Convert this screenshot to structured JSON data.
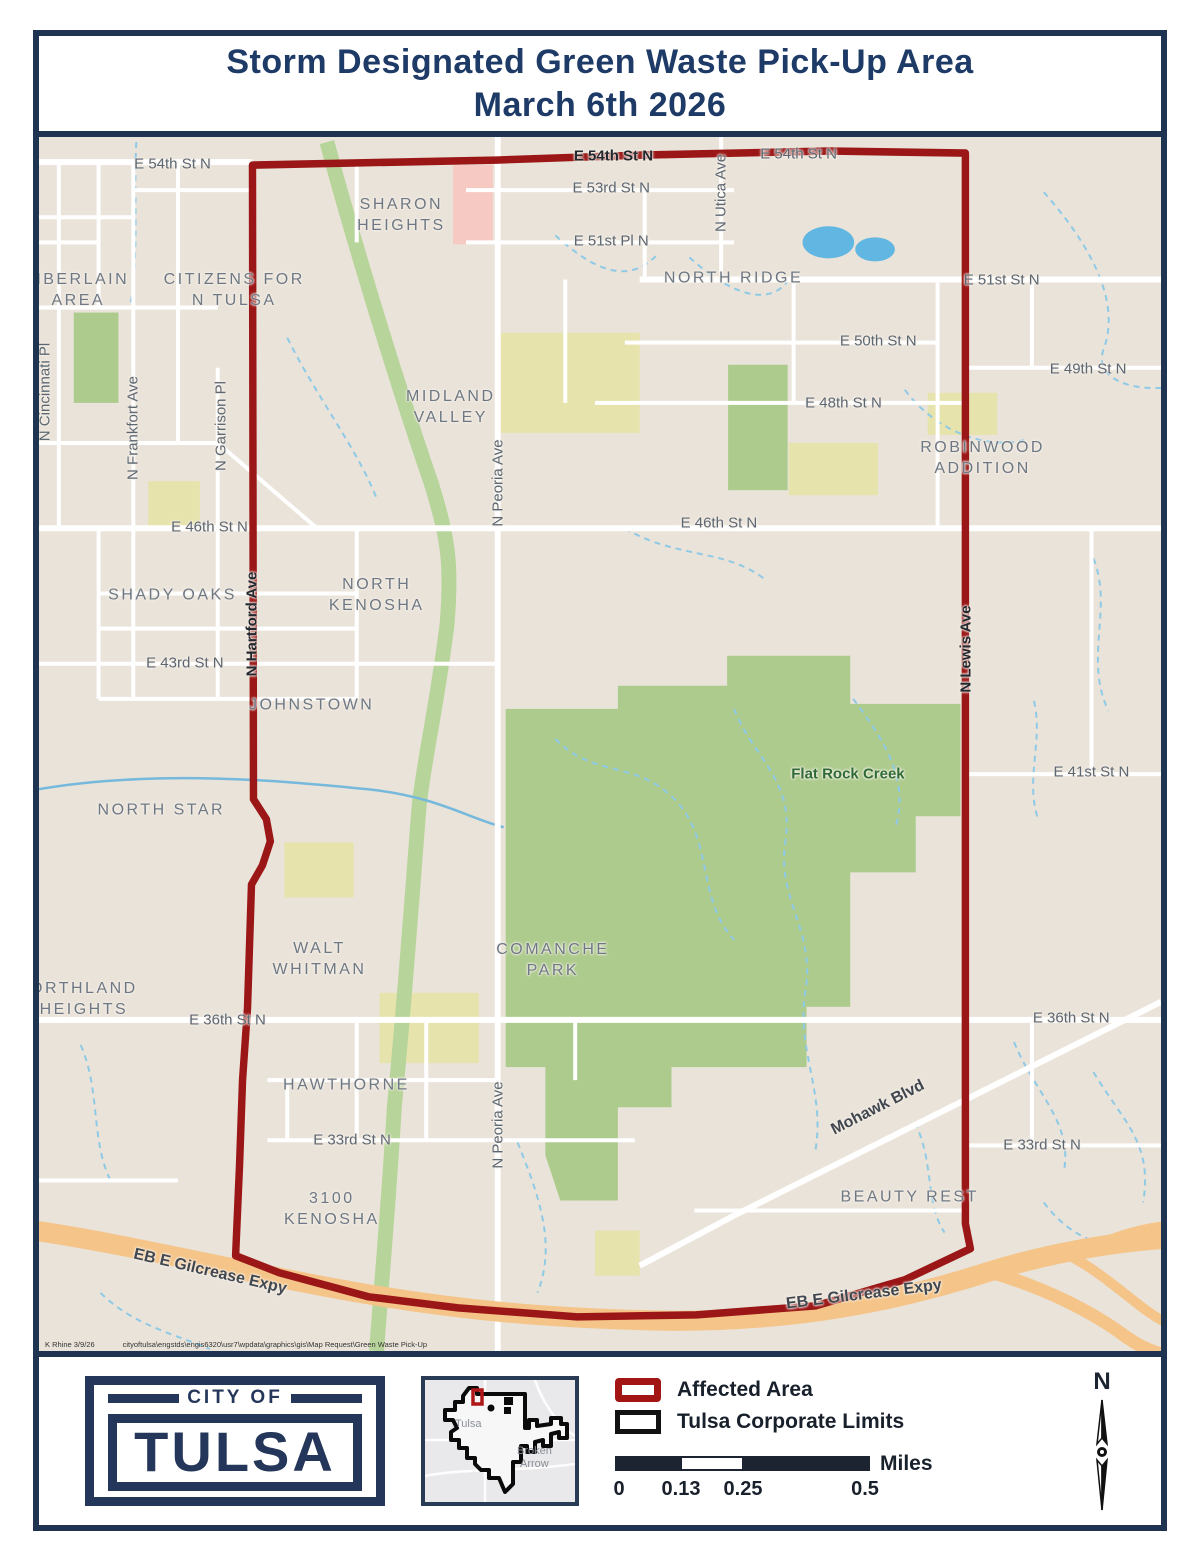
{
  "title": {
    "line1": "Storm Designated Green Waste Pick-Up Area",
    "line2": "March 6th 2026"
  },
  "colors": {
    "navy": "#1f3450",
    "boundary_red": "#9b1717",
    "legend_red": "#a31515",
    "map_bg": "#eae3d9",
    "park_green": "#aecb8e",
    "expressway_orange": "#f5c488",
    "water_blue": "#62b6e2"
  },
  "map": {
    "credit_author": "K Rhine 3/9/26",
    "credit_path": "cityoftulsa\\engstds\\engis6320\\usr7\\wpdata\\graphics\\gis\\Map Request\\Green Waste Pick-Up",
    "labels": [
      {
        "text": "E 54th St N",
        "x": 11.9,
        "y": 2.2,
        "cls": "st"
      },
      {
        "text": "E 54th St N",
        "x": 51.2,
        "y": 1.6,
        "cls": "std"
      },
      {
        "text": "E 54th St N",
        "x": 67.7,
        "y": 1.4,
        "cls": "st"
      },
      {
        "text": "E 53rd St N",
        "x": 51.0,
        "y": 4.2,
        "cls": "st"
      },
      {
        "text": "E 51st Pl N",
        "x": 51.0,
        "y": 8.6,
        "cls": "st"
      },
      {
        "text": "E 51st St N",
        "x": 85.8,
        "y": 11.8,
        "cls": "st"
      },
      {
        "text": "E 50th St N",
        "x": 74.8,
        "y": 16.8,
        "cls": "st"
      },
      {
        "text": "E 49th St N",
        "x": 93.5,
        "y": 19.1,
        "cls": "st"
      },
      {
        "text": "E 48th St N",
        "x": 71.7,
        "y": 21.9,
        "cls": "st"
      },
      {
        "text": "E 46th St N",
        "x": 15.2,
        "y": 32.1,
        "cls": "st"
      },
      {
        "text": "E 46th St N",
        "x": 60.6,
        "y": 31.8,
        "cls": "st"
      },
      {
        "text": "E 43rd St N",
        "x": 13.0,
        "y": 43.3,
        "cls": "st"
      },
      {
        "text": "E 41st St N",
        "x": 93.8,
        "y": 52.3,
        "cls": "st"
      },
      {
        "text": "E 36th St N",
        "x": 16.8,
        "y": 72.7,
        "cls": "st"
      },
      {
        "text": "E 36th St N",
        "x": 92.0,
        "y": 72.6,
        "cls": "st"
      },
      {
        "text": "E 33rd St N",
        "x": 27.9,
        "y": 82.6,
        "cls": "st"
      },
      {
        "text": "E 33rd St N",
        "x": 89.4,
        "y": 83.0,
        "cls": "st"
      },
      {
        "text": "Mohawk Blvd",
        "x": 74.8,
        "y": 80.0,
        "rot": -27,
        "cls": "stb"
      },
      {
        "text": "EB E Gilcrease Expy",
        "x": 15.2,
        "y": 93.5,
        "rot": 13,
        "cls": "stb"
      },
      {
        "text": "EB E Gilcrease Expy",
        "x": 73.5,
        "y": 95.4,
        "rot": -7,
        "cls": "stb"
      },
      {
        "text": "N Cincinnati Pl",
        "x": 0.5,
        "y": 21.0,
        "rot": -90,
        "cls": "st"
      },
      {
        "text": "N Frankfort Ave",
        "x": 8.4,
        "y": 24.0,
        "rot": -90,
        "cls": "st"
      },
      {
        "text": "N Garrison Pl",
        "x": 16.2,
        "y": 23.8,
        "rot": -90,
        "cls": "st"
      },
      {
        "text": "N Peoria Ave",
        "x": 40.9,
        "y": 28.5,
        "rot": -90,
        "cls": "st"
      },
      {
        "text": "N Peoria Ave",
        "x": 40.9,
        "y": 81.4,
        "rot": -90,
        "cls": "st"
      },
      {
        "text": "N Utica Ave",
        "x": 60.8,
        "y": 4.6,
        "rot": -90,
        "cls": "st"
      },
      {
        "text": "N Hartford Ave",
        "x": 19.0,
        "y": 40.1,
        "rot": -90,
        "cls": "std"
      },
      {
        "text": "N Lewis Ave",
        "x": 82.6,
        "y": 42.2,
        "rot": -90,
        "cls": "std"
      },
      {
        "text": "SHARON\nHEIGHTS",
        "x": 32.3,
        "y": 6.5,
        "cls": "nb"
      },
      {
        "text": "MBERLAIN\nAREA",
        "x": 3.5,
        "y": 12.7,
        "cls": "nb"
      },
      {
        "text": "CITIZENS FOR\nN TULSA",
        "x": 17.4,
        "y": 12.7,
        "cls": "nb"
      },
      {
        "text": "NORTH RIDGE",
        "x": 61.9,
        "y": 11.7,
        "cls": "nb"
      },
      {
        "text": "MIDLAND\nVALLEY",
        "x": 36.7,
        "y": 22.3,
        "cls": "nb"
      },
      {
        "text": "ROBINWOOD\nADDITION",
        "x": 84.1,
        "y": 26.5,
        "cls": "nb"
      },
      {
        "text": "SHADY OAKS",
        "x": 11.9,
        "y": 37.8,
        "cls": "nb"
      },
      {
        "text": "NORTH\nKENOSHA",
        "x": 30.1,
        "y": 37.8,
        "cls": "nb"
      },
      {
        "text": "JOHNSTOWN",
        "x": 24.3,
        "y": 46.9,
        "cls": "nb"
      },
      {
        "text": "NORTH STAR",
        "x": 10.9,
        "y": 55.5,
        "cls": "nb"
      },
      {
        "text": "ORTHLAND\nHEIGHTS",
        "x": 4.0,
        "y": 71.1,
        "cls": "nb"
      },
      {
        "text": "WALT\nWHITMAN",
        "x": 25.0,
        "y": 67.8,
        "cls": "nb"
      },
      {
        "text": "COMANCHE\nPARK",
        "x": 45.8,
        "y": 67.9,
        "cls": "nb"
      },
      {
        "text": "HAWTHORNE",
        "x": 27.4,
        "y": 78.2,
        "cls": "nb"
      },
      {
        "text": "3100\nKENOSHA",
        "x": 26.1,
        "y": 88.4,
        "cls": "nb"
      },
      {
        "text": "BEAUTY REST",
        "x": 77.6,
        "y": 87.4,
        "cls": "nb"
      },
      {
        "text": "Flat Rock Creek",
        "x": 72.1,
        "y": 52.5,
        "cls": "wt"
      }
    ]
  },
  "footer": {
    "logo": {
      "top": "CITY OF",
      "main": "TULSA"
    },
    "inset": {
      "city_label": "Tulsa",
      "neighbor_label_1": "Broken",
      "neighbor_label_2": "Arrow"
    },
    "legend": {
      "items": [
        {
          "label": "Affected Area"
        },
        {
          "label": "Tulsa Corporate Limits"
        }
      ]
    },
    "scalebar": {
      "ticks": [
        "0",
        "0.13",
        "0.25",
        "0.5"
      ],
      "unit": "Miles"
    },
    "north_label": "N"
  }
}
